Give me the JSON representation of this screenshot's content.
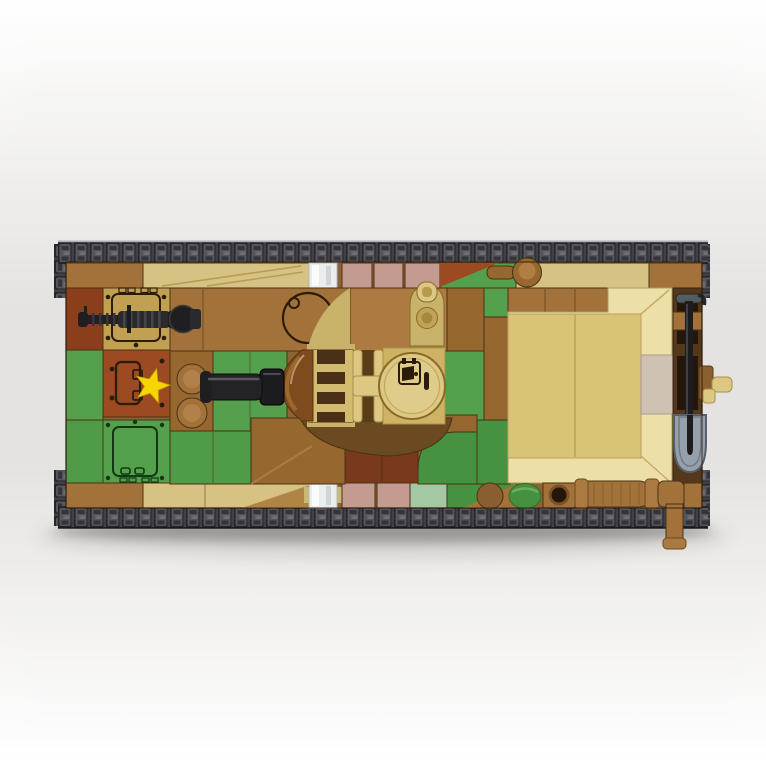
{
  "scene": {
    "title": "Overhead product photo of a brick-built military tank construction model",
    "type": "toy-product-photo",
    "view": "top-down",
    "camouflage": "tan, brown, green and rust-red camouflage pattern",
    "parts": {
      "tracks": "dark gray segmented tracks along top and bottom edges",
      "main_gun": "black main gun barrel pointing left from central turret",
      "machine_gun": "black ribbed hull machine gun pointing left at upper hull",
      "turret_hatch": "round tan commander hatch with printed icon",
      "observation_dome": "translucent brown dome at turret front",
      "periscope": "tan periscope block above turret",
      "star_decal": "yellow star printed on rust-red hatch tile",
      "hatch_tiles": "printed access-hatch tiles on left hull",
      "engine_deck": "large beveled tan engine deck on right hull",
      "shovel": "black-handled shovel with gray blade on right edge",
      "exhaust": "brown muffler and elbow exhaust pipe at lower right",
      "headlights": "transparent light bricks on front and rear edges",
      "crank_handle": "tan starter crank protruding from right edge"
    }
  },
  "colors": {
    "bg_top": "#ffffff",
    "bg_mid": "#e4e3e1",
    "track_base": "#26262a",
    "track_link": "#55555c",
    "track_notch": "#34343a",
    "track_pin": "#6d6d75",
    "track_edge": "#404046",
    "brown": "#a3713a",
    "brown2": "#96672f",
    "brown_light": "#ad7a42",
    "brown_deep": "#7c5526",
    "dark_brown": "#6b4a22",
    "channel": "#53381c",
    "slot_dark": "#241608",
    "red_brown": "#9b4a21",
    "rust_dark": "#8a3e1b",
    "maroon": "#79391d",
    "tan": "#d6c283",
    "tan_deck": "#d9c377",
    "cream": "#ece0a8",
    "tan_print": "#c2a052",
    "tan_hatch": "#dcc783",
    "tan_plate": "#cdb363",
    "khaki": "#c9b26a",
    "khaki2": "#cdb873",
    "greige": "#cfc1b3",
    "pink": "#c49b91",
    "sage": "#a4c8a4",
    "green": "#55a04c",
    "green2": "#459340",
    "green3": "#4f9b47",
    "green_cyl": "#46913f",
    "yellow": "#f6d500",
    "black": "#1f1f22",
    "black2": "#2a2a2e",
    "gray_metal": "#96a0ab",
    "gray_dark": "#55606c",
    "trans_clear": "#e9eded",
    "trans_brown": "#7d4b1d",
    "trans_brown_hi": "#a5702f",
    "print_dark": "#2a1c08",
    "outline": "#4a3214"
  }
}
